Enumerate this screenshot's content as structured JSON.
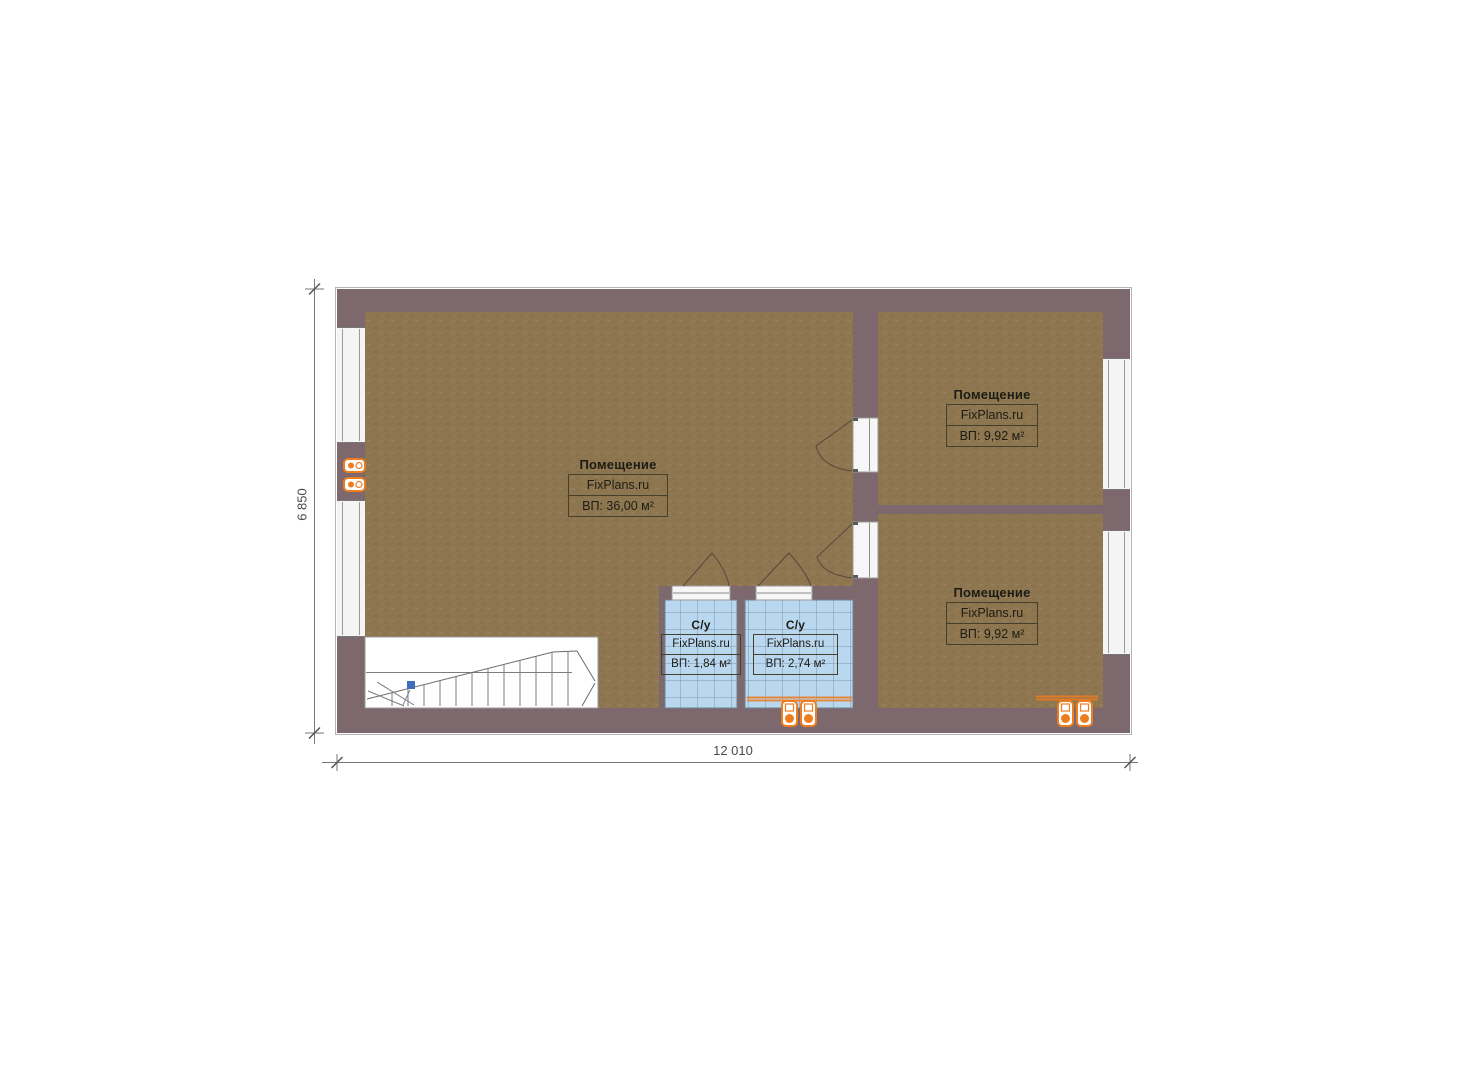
{
  "document": {
    "kind": "floor-plan",
    "source_brand": "FixPlans.ru"
  },
  "rooms": [
    {
      "id": "room-main",
      "title": "Помещение",
      "brand": "FixPlans.ru",
      "area": "ВП: 36,00 м²"
    },
    {
      "id": "room-top-right",
      "title": "Помещение",
      "brand": "FixPlans.ru",
      "area": "ВП: 9,92 м²"
    },
    {
      "id": "room-bottom-right",
      "title": "Помещение",
      "brand": "FixPlans.ru",
      "area": "ВП: 9,92 м²"
    },
    {
      "id": "bath-left",
      "title": "С/у",
      "brand": "FixPlans.ru",
      "area": "ВП: 1,84 м²"
    },
    {
      "id": "bath-right",
      "title": "С/у",
      "brand": "FixPlans.ru",
      "area": "ВП: 2,74 м²"
    }
  ],
  "dimensions": {
    "width_label": "12 010",
    "height_label": "6 850"
  },
  "colors": {
    "wall": "#7d696d",
    "floor": "#8d7650",
    "tile": "#bad7f0",
    "tile_grid": "#7e95aa",
    "window": "#f4f4f4",
    "stairs": "#ffffff",
    "accent_orange": "#ee7d20",
    "marker_blue": "#3f6dbd",
    "dimension_line": "#777777",
    "label_border": "#44402e"
  },
  "icons": {
    "wall_sockets": "double-socket-icon",
    "stairs": "staircase-icon",
    "doors": "door-swing-icon",
    "windows": "window-icon"
  }
}
